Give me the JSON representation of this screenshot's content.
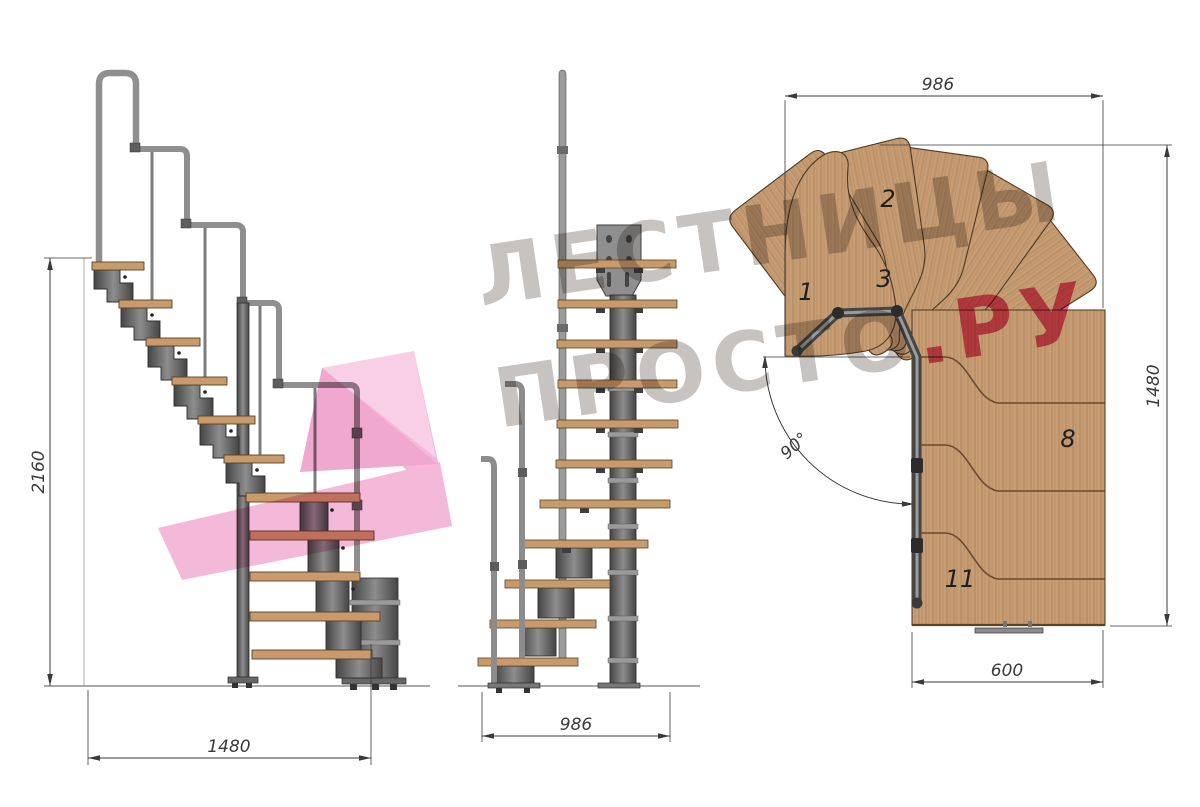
{
  "watermark": {
    "line1": "ЛЕСТНИЦЫ",
    "line2_gray": "ПРОСТО",
    "line2_pink": ".РУ",
    "gray_color": "#c6c3c0",
    "pink_color": "#e25c87",
    "ribbon_pink": "#f3b6d7"
  },
  "views": {
    "side": {
      "dim_height": "2160",
      "dim_width": "1480"
    },
    "front": {
      "dim_width": "986"
    },
    "plan": {
      "dim_top": "986",
      "dim_right": "1480",
      "dim_bottom": "600",
      "angle_label": "90°",
      "labels": {
        "t1": "1",
        "t2": "2",
        "t3": "3",
        "t8": "8",
        "t11": "11"
      }
    }
  },
  "colors": {
    "wood": "#c9a078",
    "wood_edge": "#5a4326",
    "metal": "#6b6b6b",
    "metal_dark": "#2e2e2e",
    "rail": "#8f8f8f",
    "dimension": "#3a3a3a"
  }
}
